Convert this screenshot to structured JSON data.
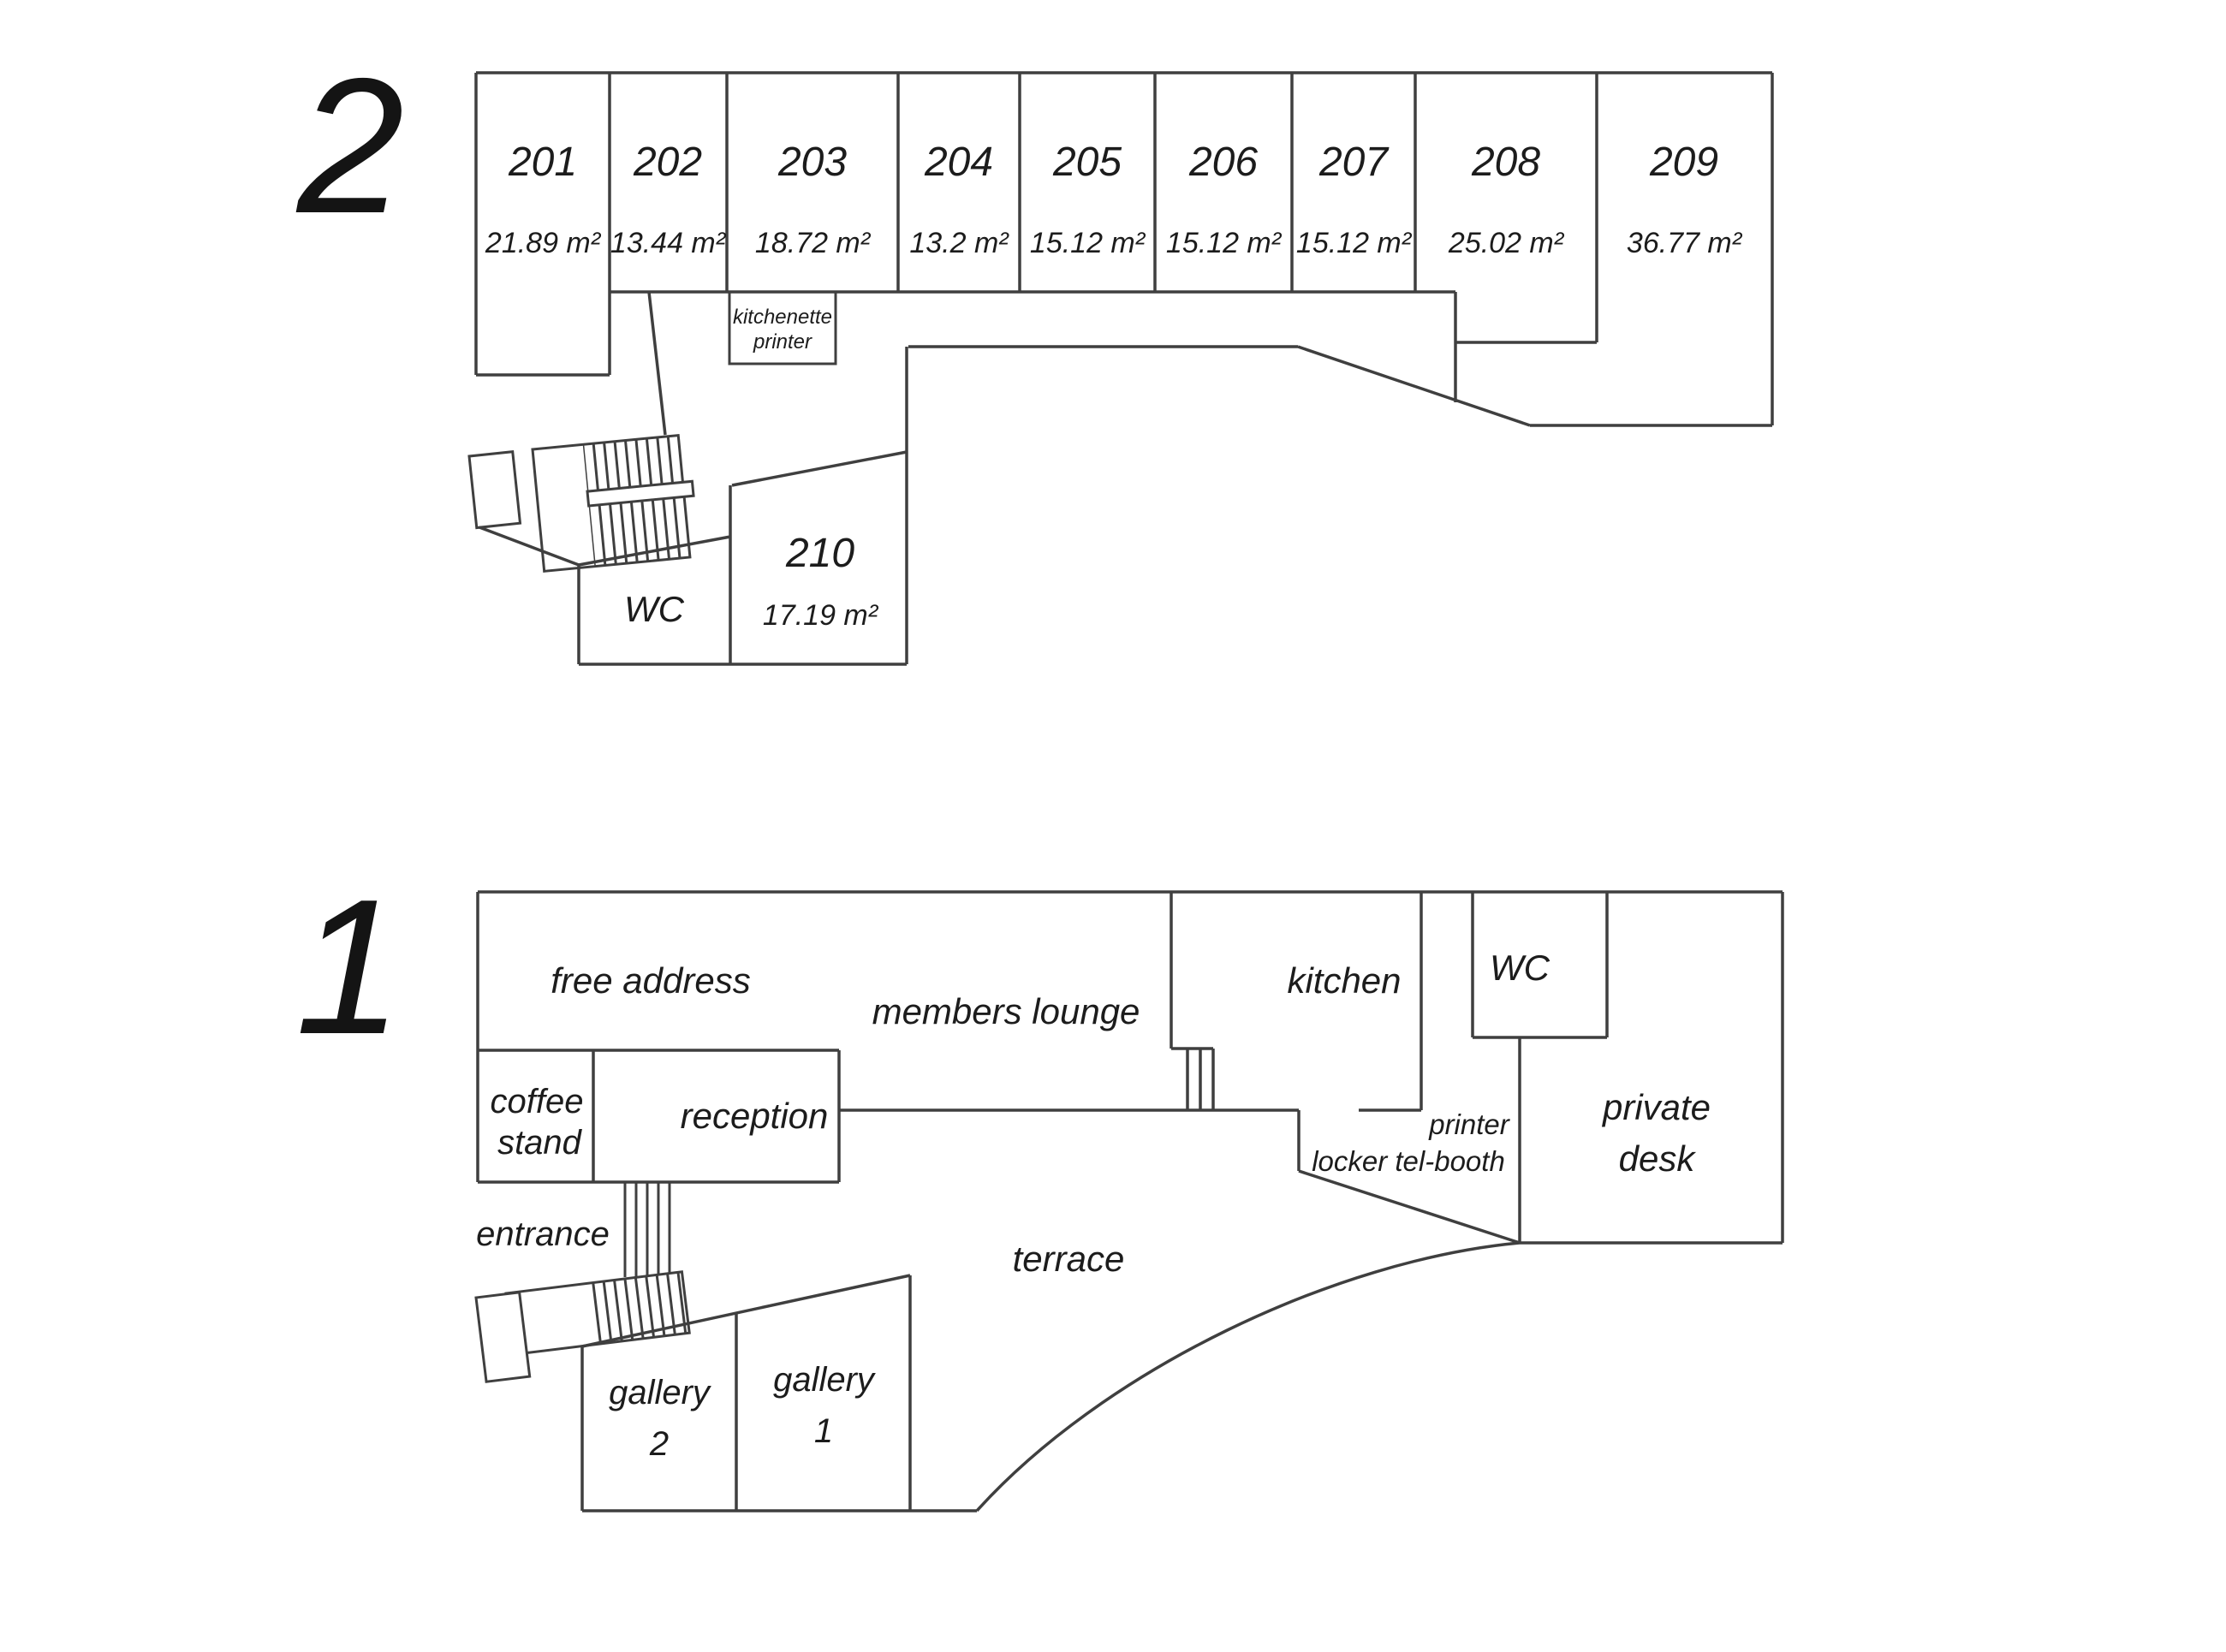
{
  "colors": {
    "background": "#ffffff",
    "line": "#3f3f3f",
    "text": "#1c1c1c"
  },
  "floor2": {
    "numeral": "2",
    "rooms": [
      {
        "number": "201",
        "area": "21.89 m²"
      },
      {
        "number": "202",
        "area": "13.44 m²"
      },
      {
        "number": "203",
        "area": "18.72 m²"
      },
      {
        "number": "204",
        "area": "13.2 m²"
      },
      {
        "number": "205",
        "area": "15.12 m²"
      },
      {
        "number": "206",
        "area": "15.12 m²"
      },
      {
        "number": "207",
        "area": "15.12 m²"
      },
      {
        "number": "208",
        "area": "25.02 m²"
      },
      {
        "number": "209",
        "area": "36.77 m²"
      }
    ],
    "room210": {
      "number": "210",
      "area": "17.19 m²"
    },
    "wc_label": "WC",
    "kitchenette": [
      "kitchenette",
      "printer"
    ]
  },
  "floor1": {
    "numeral": "1",
    "labels": {
      "free_address": "free address",
      "members_lounge": "members lounge",
      "coffee_stand": [
        "coffee",
        "stand"
      ],
      "reception": "reception",
      "entrance": "entrance",
      "terrace": "terrace",
      "gallery2": [
        "gallery",
        "2"
      ],
      "gallery1": [
        "gallery",
        "1"
      ],
      "kitchen": "kitchen",
      "wc": "WC",
      "printer": "printer",
      "locker_telbooth": "locker tel-booth",
      "private_desk": [
        "private",
        "desk"
      ]
    }
  }
}
